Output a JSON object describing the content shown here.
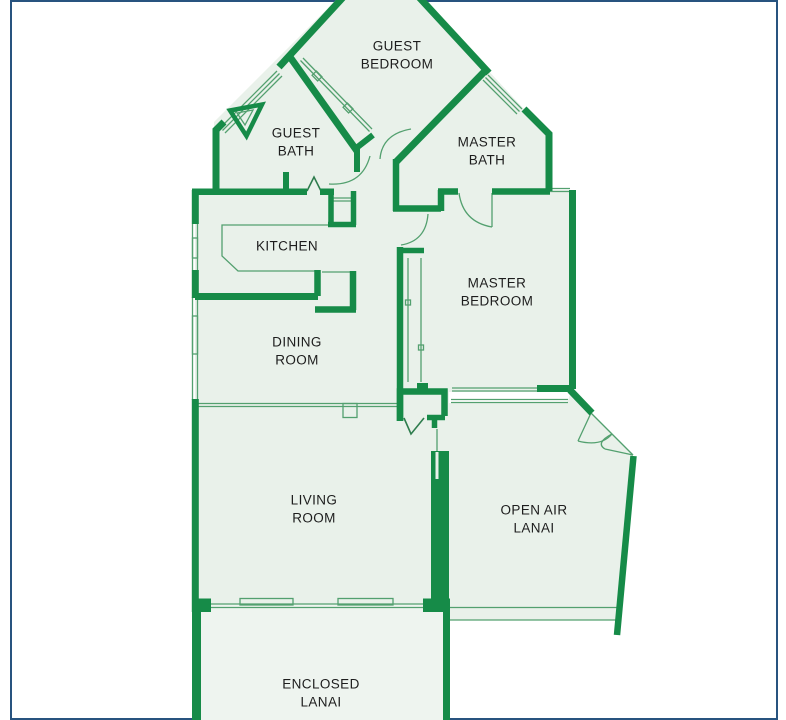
{
  "plan": {
    "type": "condo-floor-plan",
    "rooms": {
      "guest_bedroom": {
        "label": "GUEST\nBEDROOM"
      },
      "guest_bath": {
        "label": "GUEST\nBATH"
      },
      "master_bath": {
        "label": "MASTER\nBATH"
      },
      "kitchen": {
        "label": "KITCHEN"
      },
      "master_bedroom": {
        "label": "MASTER\nBEDROOM"
      },
      "dining_room": {
        "label": "DINING\nROOM"
      },
      "living_room": {
        "label": "LIVING\nROOM"
      },
      "open_air_lanai": {
        "label": "OPEN AIR\nLANAI"
      },
      "enclosed_lanai": {
        "label": "ENCLOSED\nLANAI"
      }
    },
    "colors": {
      "wall_green": "#168b48",
      "thin_line_green": "#53a06f",
      "room_fill": "#e9f1ea",
      "enclosed_lanai_fill": "#eef4ef",
      "frame_navy": "#28537f",
      "label_text": "#1d1d1d",
      "background": "#ffffff"
    }
  }
}
